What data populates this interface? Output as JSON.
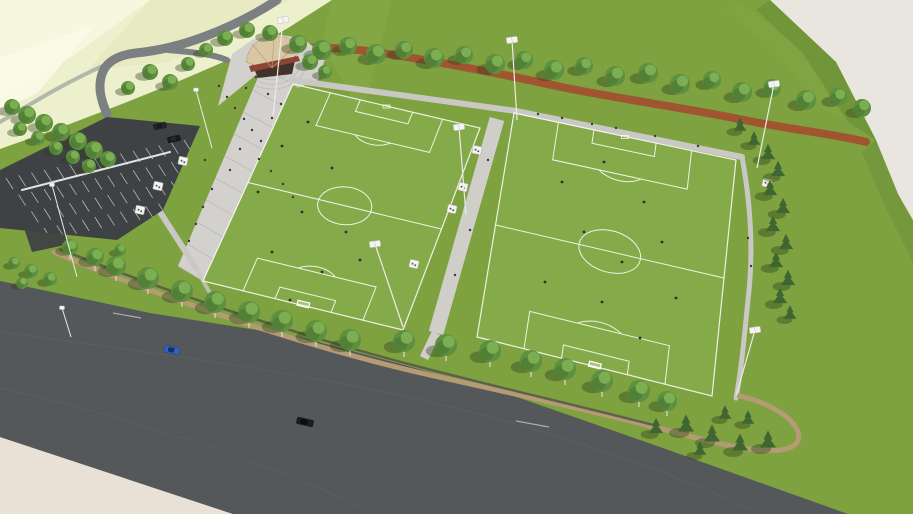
{
  "meta": {
    "subject": "Aerial 3D architectural rendering of a two-field soccer complex with entry plaza, shell pavilion, parking lot, running track, tree-lined perimeter trail and an adjacent multi-lane road",
    "width": 913,
    "height": 514
  },
  "colors": {
    "bg": "#e9e5df",
    "bgWarm": "#e9e1d6",
    "pale1": "#edf0cc",
    "pale2": "#f5f7e0",
    "pale3": "#e3e8b8",
    "paleStreak": "#f9fbe8",
    "grass": "#7da23f",
    "grassLight": "#8cae4e",
    "field": "#8db254",
    "slope": "#6d9038",
    "slopeLight": "#86a84a",
    "road": "#55585b",
    "roadSeam": "#63666a",
    "nwRoad": "#7c8083",
    "pathGray": "#c9c8c4",
    "walkway": "#cfcec9",
    "plaza": "#d2d1cd",
    "step": "#b7b6b2",
    "parking": "#3f4245",
    "track": "#a2512f",
    "trail": "#b49b74",
    "wall": "#56564a",
    "treeFill": "#5e9040",
    "treeHi": "#7fb254",
    "treeLo": "#47732f",
    "treeShadow": "#2c3d1e",
    "conifer": "#3f6530",
    "trunk": "#d6cfbc",
    "pavRoof": "#d8c7a2",
    "pavEdge": "#b89f72",
    "pavAccent": "#8e4434",
    "pavDark": "#43322c",
    "person": "#3a3a3c",
    "player": "#2f2f2f",
    "carBlue": "#2f62cf",
    "carBlueDark": "#16306e",
    "carBlack": "#1d1d20",
    "carBlackRoof": "#0c0c0e",
    "carDark1": "#26262a",
    "carDark2": "#1a1a1e",
    "lampWhite": "#f4f4f0",
    "lampEdge": "#c2c2bd",
    "pole": "#ecece8"
  },
  "scene": {
    "fields": [
      {
        "name": "west-field",
        "quad": [
          [
            293,
            84
          ],
          [
            480,
            128
          ],
          [
            403,
            330
          ],
          [
            203,
            281
          ]
        ]
      },
      {
        "name": "east-field",
        "quad": [
          [
            514,
            113
          ],
          [
            736,
            160
          ],
          [
            712,
            396
          ],
          [
            477,
            337
          ]
        ]
      }
    ],
    "plaza": {
      "stepEdgeA": [
        [
          262,
          68
        ],
        [
          178,
          266
        ]
      ],
      "stepEdgeB": [
        [
          293,
          84
        ],
        [
          203,
          281
        ]
      ],
      "steps": 10,
      "fanCenter": [
        272,
        62
      ],
      "fanRadii": [
        16,
        22,
        28,
        34
      ]
    },
    "parking": {
      "clip": "0,170 107,117 200,126 163,210 117,240 0,228",
      "origin": [
        6,
        178
      ],
      "u": [
        178,
        -38
      ],
      "v": [
        38,
        50
      ],
      "rows": 4,
      "stalls": 14,
      "tick": [
        7,
        11
      ]
    },
    "trees": {
      "topRow": [
        [
          298,
          44,
          9
        ],
        [
          322,
          50,
          10
        ],
        [
          348,
          46,
          9
        ],
        [
          376,
          54,
          10
        ],
        [
          404,
          50,
          9
        ],
        [
          434,
          58,
          10
        ],
        [
          464,
          55,
          9
        ],
        [
          495,
          64,
          10
        ],
        [
          524,
          60,
          9
        ],
        [
          554,
          70,
          10
        ],
        [
          584,
          66,
          9
        ],
        [
          615,
          76,
          10
        ],
        [
          648,
          73,
          10
        ],
        [
          680,
          84,
          10
        ],
        [
          712,
          80,
          9
        ],
        [
          742,
          92,
          10
        ],
        [
          772,
          88,
          9
        ],
        [
          806,
          100,
          10
        ],
        [
          838,
          97,
          9
        ],
        [
          862,
          108,
          9
        ],
        [
          225,
          38,
          8
        ],
        [
          247,
          30,
          8
        ],
        [
          270,
          33,
          8
        ],
        [
          206,
          50,
          7
        ],
        [
          150,
          72,
          8
        ],
        [
          170,
          82,
          8
        ],
        [
          188,
          64,
          7
        ],
        [
          128,
          88,
          7
        ],
        [
          310,
          62,
          8
        ],
        [
          325,
          72,
          7
        ]
      ],
      "leftRow": [
        [
          12,
          107,
          8
        ],
        [
          27,
          115,
          9
        ],
        [
          44,
          123,
          9
        ],
        [
          61,
          132,
          9
        ],
        [
          78,
          141,
          9
        ],
        [
          94,
          150,
          9
        ],
        [
          108,
          159,
          8
        ],
        [
          20,
          129,
          7
        ],
        [
          38,
          138,
          7
        ],
        [
          56,
          148,
          7
        ],
        [
          73,
          157,
          7
        ],
        [
          89,
          166,
          7
        ]
      ],
      "bottomRow": [
        [
          70,
          247,
          8
        ],
        [
          95,
          257,
          9
        ],
        [
          116,
          266,
          10
        ],
        [
          148,
          278,
          11
        ],
        [
          182,
          291,
          11
        ],
        [
          215,
          302,
          11
        ],
        [
          249,
          312,
          11
        ],
        [
          282,
          321,
          11
        ],
        [
          316,
          331,
          11
        ],
        [
          350,
          340,
          11
        ],
        [
          404,
          341,
          11
        ],
        [
          446,
          345,
          11
        ],
        [
          490,
          351,
          11
        ],
        [
          531,
          361,
          11
        ],
        [
          565,
          369,
          11
        ],
        [
          602,
          381,
          11
        ],
        [
          639,
          391,
          11
        ],
        [
          667,
          401,
          10
        ]
      ],
      "bushes": [
        [
          14,
          263,
          6
        ],
        [
          31,
          271,
          7
        ],
        [
          50,
          279,
          7
        ],
        [
          22,
          283,
          6
        ],
        [
          120,
          250,
          6
        ]
      ],
      "conifers": [
        [
          740,
          128,
          8
        ],
        [
          754,
          142,
          8
        ],
        [
          768,
          156,
          9
        ],
        [
          778,
          173,
          9
        ],
        [
          770,
          192,
          9
        ],
        [
          783,
          210,
          9
        ],
        [
          773,
          228,
          9
        ],
        [
          786,
          246,
          9
        ],
        [
          776,
          264,
          9
        ],
        [
          788,
          282,
          9
        ],
        [
          780,
          300,
          9
        ],
        [
          790,
          316,
          8
        ],
        [
          656,
          430,
          9
        ],
        [
          686,
          428,
          10
        ],
        [
          712,
          438,
          10
        ],
        [
          740,
          447,
          10
        ],
        [
          768,
          444,
          10
        ],
        [
          700,
          452,
          8
        ],
        [
          725,
          416,
          8
        ],
        [
          748,
          421,
          8
        ]
      ]
    },
    "shelters": [
      [
        477,
        150
      ],
      [
        463,
        187
      ],
      [
        452,
        209
      ],
      [
        414,
        264
      ],
      [
        183,
        161
      ],
      [
        158,
        186
      ],
      [
        140,
        210
      ],
      [
        767,
        183
      ]
    ],
    "floodlights": [
      {
        "head": [
          283,
          20
        ],
        "base": [
          273,
          117
        ]
      },
      {
        "head": [
          512,
          40
        ],
        "base": [
          517,
          120
        ]
      },
      {
        "head": [
          774,
          84
        ],
        "base": [
          757,
          168
        ]
      },
      {
        "head": [
          459,
          127
        ],
        "base": [
          466,
          215
        ]
      },
      {
        "head": [
          375,
          244
        ],
        "base": [
          403,
          327
        ]
      },
      {
        "head": [
          755,
          330
        ],
        "base": [
          736,
          396
        ]
      }
    ],
    "lamps": [
      {
        "head": [
          52,
          185
        ],
        "base": [
          77,
          277
        ]
      },
      {
        "head": [
          196,
          90
        ],
        "base": [
          212,
          148
        ]
      },
      {
        "head": [
          62,
          308
        ],
        "base": [
          71,
          337
        ]
      }
    ],
    "people": [
      [
        219,
        86
      ],
      [
        227,
        97
      ],
      [
        235,
        108
      ],
      [
        244,
        119
      ],
      [
        252,
        130
      ],
      [
        261,
        141
      ],
      [
        246,
        88
      ],
      [
        256,
        77
      ],
      [
        268,
        94
      ],
      [
        272,
        118
      ],
      [
        281,
        104
      ],
      [
        240,
        149
      ],
      [
        259,
        159
      ],
      [
        271,
        171
      ],
      [
        283,
        184
      ],
      [
        293,
        197
      ],
      [
        203,
        207
      ],
      [
        196,
        224
      ],
      [
        189,
        241
      ],
      [
        212,
        189
      ],
      [
        230,
        170
      ],
      [
        205,
        160
      ],
      [
        538,
        114
      ],
      [
        562,
        118
      ],
      [
        592,
        124
      ],
      [
        616,
        128
      ],
      [
        655,
        136
      ],
      [
        698,
        146
      ],
      [
        748,
        238
      ],
      [
        751,
        266
      ],
      [
        488,
        160
      ],
      [
        470,
        230
      ],
      [
        455,
        275
      ]
    ],
    "players": {
      "west": [
        [
          308,
          122
        ],
        [
          282,
          146
        ],
        [
          332,
          168
        ],
        [
          258,
          192
        ],
        [
          302,
          212
        ],
        [
          346,
          232
        ],
        [
          272,
          252
        ],
        [
          322,
          272
        ],
        [
          290,
          300
        ],
        [
          360,
          260
        ]
      ],
      "east": [
        [
          562,
          182
        ],
        [
          604,
          162
        ],
        [
          644,
          202
        ],
        [
          584,
          232
        ],
        [
          622,
          262
        ],
        [
          662,
          242
        ],
        [
          545,
          282
        ],
        [
          602,
          302
        ],
        [
          676,
          298
        ],
        [
          640,
          338
        ]
      ]
    },
    "vehicles": {
      "road": [
        {
          "x": 172,
          "y": 350,
          "angle": 12,
          "length": 15,
          "width": 7,
          "body": "carBlue",
          "roof": "carBlueDark"
        },
        {
          "x": 305,
          "y": 422,
          "angle": 13,
          "length": 17,
          "width": 7,
          "body": "carBlack",
          "roof": "carBlackRoof"
        }
      ],
      "parked": [
        {
          "x": 160,
          "y": 126,
          "angle": -12,
          "length": 13,
          "width": 6,
          "body": "carDark1",
          "roof": "carDark2"
        },
        {
          "x": 174,
          "y": 139,
          "angle": -12,
          "length": 13,
          "width": 6,
          "body": "carDark2",
          "roof": "carDark1"
        }
      ]
    }
  }
}
